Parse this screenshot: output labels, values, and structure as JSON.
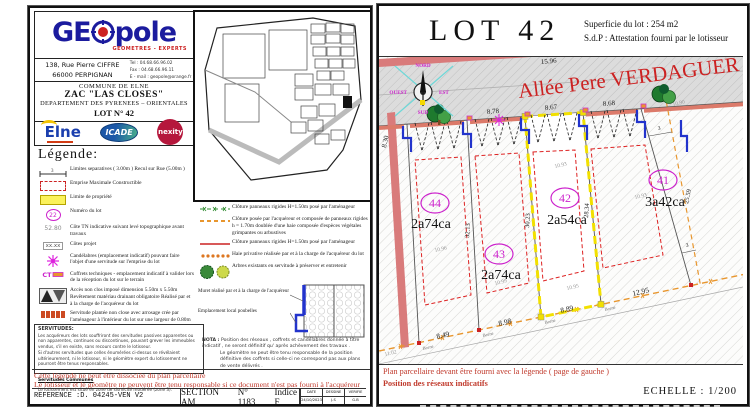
{
  "left_page": {
    "header": {
      "logo_ge": "GE",
      "logo_pole": "pole",
      "logo_subtitle": "GEOMETRES - EXPERTS",
      "address_line1": "138, Rue Pierre CIFFRE",
      "address_line2": "66000  PERPIGNAN",
      "tel": "Tel : 04.68.66.96.02",
      "fax": "Fax : 04.68.66.96.11",
      "email": "E - mail : geopole@orange.fr"
    },
    "title_block": {
      "line1": "COMMUNE DE ELNE",
      "line2": "ZAC \"LAS CLOSES\"",
      "line3": "DEPARTEMENT  DES  PYRENEES  –  ORIENTALES",
      "line4": "LOT  N° 42"
    },
    "logos": {
      "elne": "Elne",
      "icade": "ICADE",
      "nexity": "nexity"
    },
    "legend": {
      "heading": "Légende:",
      "items_left": [
        {
          "sym": "3",
          "text": "Limites separatives ( 3.00m ) Recul sur Rue (5.00m )"
        },
        {
          "text": "Emprise Maximale Constructible"
        },
        {
          "text": "Limite de propriété"
        },
        {
          "sym": "22",
          "text": "Numéro du lot"
        },
        {
          "sym": "52.80",
          "text": "Côte TN indicative suivant levé topographique avant travaux"
        },
        {
          "sym": "xx.xx",
          "text": "Côtes projet"
        },
        {
          "text": "Candélabres (emplacement indicatif) pouvant faire l'objet d'une servitude sur l'emprise du lot"
        },
        {
          "sym": "CT",
          "text": "Coffrets techniques - emplacement indicatif à valider lors de la réception du lot sur le terrain"
        },
        {
          "text": "Accès non clos imposé dimension 5.50m x 5.50m Revêtement matériau drainant obligatoire Réalisé par et à la charge de l'acquéreur du lot"
        },
        {
          "text": "Servitude plantée non close avec arrosage crée par l'aménageur à l'intérieur du lot sur une largeur de 0.80m"
        }
      ],
      "items_right": [
        {
          "text": "Clôture panneaux rigides H=1.50m posé par l'aménageur"
        },
        {
          "text": "Clôture posée par l'acquéreur et composée de panneaux rigides h = 1.70m doublée d'une haie composée d'espèces végétales grimpantes ou arbustives"
        },
        {
          "text": "Clôture panneaux rigides H=1.50m posé par l'aménageur"
        },
        {
          "text": "Haie privative réalisée par et à la charge de l'acquéreur du lot"
        },
        {
          "text": "Arbres existants en servitude à préserver et entretenir"
        }
      ],
      "muret": {
        "label1": "Muret réalisé par et à la charge de l'acquéreur",
        "label2": "Emplacement local poubelles"
      }
    },
    "servitudes": {
      "heading": "SERVITUDES:",
      "p1": "Les acquéreurs des lots souffriront des servitudes passives apparentes ou non apparentes, continues ou discontinues, pouvant grever les immeubles vendus, s'il en existe, sans recours contre le lotisseur.",
      "p2": "Si d'autres servitudes que celles énumérées ci-dessus se révélaient ultérieurement, ni le lotisseur, ni le géomètre expert du lotissement ne pourront être tenus responsables.",
      "heading2": "Servitudes Communes",
      "p3": "Le lotissement est situé en zone de sismicité modérée (zone 3)."
    },
    "nota": {
      "label": "NOTA :",
      "p1": "Position des réseaux , coffrets et candélabres donnée à titre indicatif , ne seront définitif qu' après achèvement des travaux .",
      "p2": "Le géomètre ne peut être tenu responsable de la position définitive des coffrets si celle-ci ne correspond pas aux plans de vente délivrés ."
    },
    "disclaimer": {
      "line1": "Cette légende ne peut être dissociée du plan parcellaire",
      "line2": "Le lotisseur et le géomètre ne peuvent être tenu responsable si ce document n'est pas fourni à l'acquéreur"
    },
    "footer": {
      "reference": "REFERENCE :D. 04245-VEN V2",
      "section": "SECTION AM",
      "numero": "N° 1183",
      "indice": "Indice F",
      "date_label": "DATE",
      "date": "24/10/2023",
      "dessine_label": "DESSINE",
      "dessine": "J.S",
      "verifie_label": "VERIFIE",
      "verifie": "G.B"
    }
  },
  "right_page": {
    "header": {
      "lot_title": "LOT  42",
      "superficie": "Superficie  du lot : 254 m2",
      "sdp": "S.d.P : Attestation fourni par le lotisseur"
    },
    "plan": {
      "street_name": "Allée Pere VERDAGUER",
      "compass": {
        "n": "NORD",
        "e": "EST",
        "s": "SUD",
        "w": "OUEST"
      },
      "lots": [
        {
          "num": "44",
          "area": "2a74ca"
        },
        {
          "num": "43",
          "area": "2a74ca"
        },
        {
          "num": "42",
          "area": "2a54ca"
        },
        {
          "num": "41",
          "area": "3a42ca"
        }
      ],
      "borne_label": "Borne",
      "m": {
        "street": "15.96",
        "left_edge": "8.30",
        "front_43": "8.78",
        "front_42": "8.67",
        "front_41": "8.68",
        "side_44_43": "32.13",
        "side_43_42": "30.23",
        "side_42_41": "28.34",
        "side_41_right": "25.59",
        "rear_44": "8.49",
        "rear_43": "8.98",
        "rear_42": "8.89",
        "rear_41": "12.95",
        "servitude_width": "3",
        "tn": [
          "10.96",
          "10.99",
          "10.93",
          "10.95",
          "10.93",
          "10.90",
          "11.02"
        ]
      }
    },
    "footer": {
      "note1": "Plan parcellaire devant être fourni avec la légende ( page de gauche )",
      "note2": "Position des réseaux indicatifs",
      "scale": "ECHELLE : 1/200"
    }
  }
}
